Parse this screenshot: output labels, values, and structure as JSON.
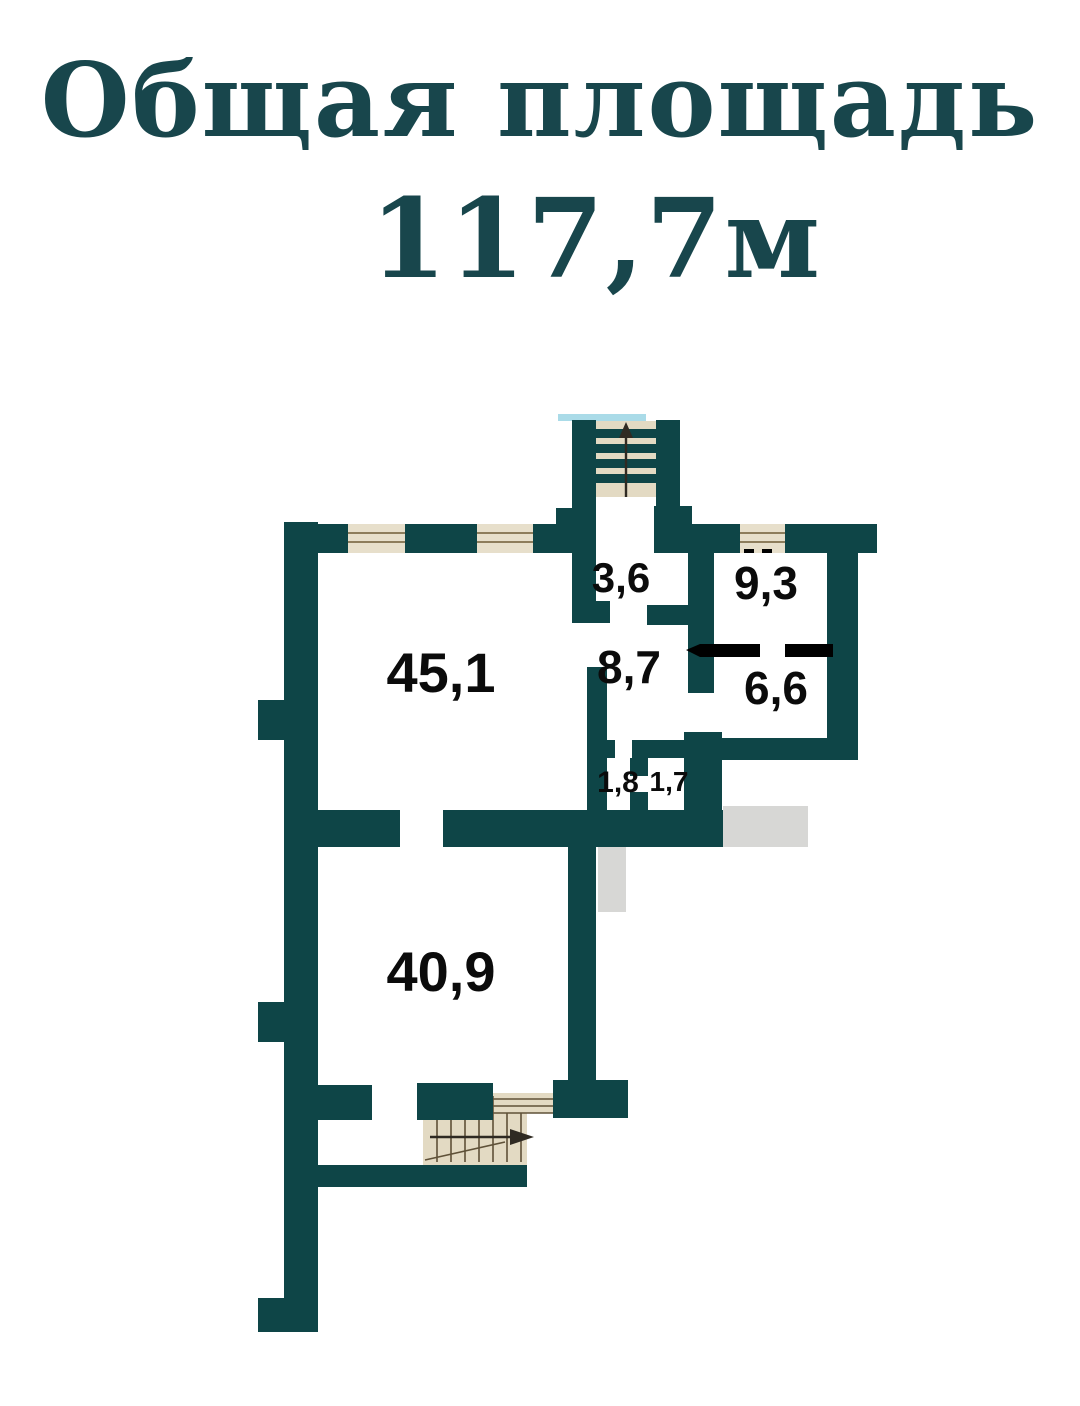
{
  "title": {
    "line1": "Общая площадь",
    "line2": "117,7м"
  },
  "total_area": {
    "value": "117,7",
    "unit": "м"
  },
  "rooms": [
    {
      "name": "room-45-1",
      "area": "45,1"
    },
    {
      "name": "room-3-6",
      "area": "3,6"
    },
    {
      "name": "room-9-3",
      "area": "9,3"
    },
    {
      "name": "room-8-7",
      "area": "8,7"
    },
    {
      "name": "room-6-6",
      "area": "6,6"
    },
    {
      "name": "room-1-8",
      "area": "1,8"
    },
    {
      "name": "room-1-7",
      "area": "1,7"
    },
    {
      "name": "room-40-9",
      "area": "40,9"
    }
  ],
  "icons": {
    "top_staircase_direction": "up",
    "bottom_staircase_direction": "right"
  },
  "colors": {
    "wall": "#0e4547",
    "title_text": "#18464c",
    "label_text": "#0b0b0b",
    "window_fill": "#e7dfcb",
    "window_line": "#8d7d5c",
    "stair_fill": "#e3dac3",
    "stair_line": "#5f5138",
    "shading": "#d7d7d5",
    "partition": "#000000",
    "marker_blue": "#aadbe8",
    "arrow": "#2f2a22"
  }
}
